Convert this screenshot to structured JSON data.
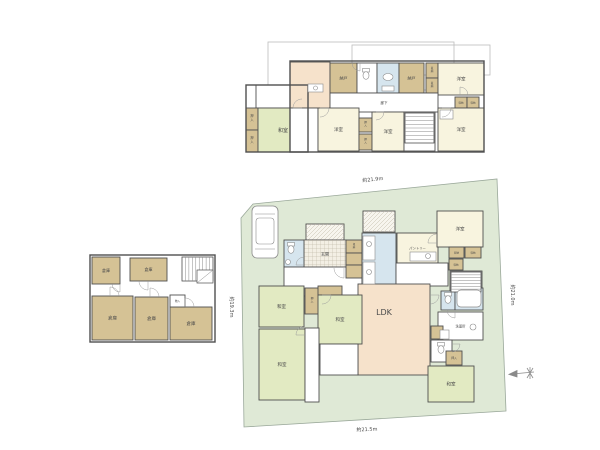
{
  "canvas": {
    "w": 600,
    "h": 450,
    "bg": "#ffffff"
  },
  "palette": {
    "g": "#e2eac2",
    "c": "#f8f4df",
    "t": "#d5c295",
    "b": "#d6e5ee",
    "p": "#f6e2cb",
    "w": "#ffffff",
    "hg": "#f3efe4",
    "hd": "#f7f5ee",
    "lot": "#dfe9d6",
    "lot_stroke": "#9aa89a",
    "wall": "#4f4f4f",
    "ref": "#bcbcbc",
    "fixture": "#8a8a8a",
    "text": "#4a4a4a",
    "dim_text": "#666666"
  },
  "lot": {
    "points": "241,218 253,204 497,179 506,411 244,427",
    "dims": [
      {
        "text": "約21.9m",
        "x": 373,
        "y": 181,
        "rot": -6
      },
      {
        "text": "約21.5m",
        "x": 367,
        "y": 431,
        "rot": -2
      },
      {
        "text": "約19.3m",
        "x": 230,
        "y": 307,
        "rot": 90
      },
      {
        "text": "約21.0m",
        "x": 511,
        "y": 295,
        "rot": 90
      }
    ]
  },
  "compass": {
    "x": 521,
    "y": 373
  },
  "floors": [
    {
      "id": "floor-plan-2f",
      "ref_outlines": [
        [
          268,
          42,
          186,
          48
        ],
        [
          352,
          45,
          138,
          30
        ]
      ],
      "wall_rects": [
        [
          246,
          85,
          62,
          67
        ],
        [
          290,
          61,
          194,
          91
        ]
      ],
      "rooms": [
        {
          "x": 256,
          "y": 85,
          "w": 34,
          "h": 23,
          "f": "w"
        },
        {
          "x": 246,
          "y": 108,
          "w": 12,
          "h": 22,
          "f": "t",
          "l": "押入",
          "v": 1,
          "fs": 3.2
        },
        {
          "x": 246,
          "y": 130,
          "w": 12,
          "h": 22,
          "f": "t",
          "l": "押入",
          "v": 1,
          "fs": 3.2
        },
        {
          "x": 258,
          "y": 108,
          "w": 50,
          "h": 44,
          "f": "g",
          "l": "和室",
          "fs": 5
        },
        {
          "x": 290,
          "y": 62,
          "w": 40,
          "h": 46,
          "f": "p"
        },
        {
          "x": 290,
          "y": 108,
          "w": 28,
          "h": 44,
          "f": "w"
        },
        {
          "x": 330,
          "y": 63,
          "w": 27,
          "h": 30,
          "f": "t",
          "l": "納戸",
          "fs": 4
        },
        {
          "x": 357,
          "y": 63,
          "w": 20,
          "h": 30,
          "f": "w"
        },
        {
          "x": 377,
          "y": 63,
          "w": 22,
          "h": 30,
          "f": "b"
        },
        {
          "x": 399,
          "y": 63,
          "w": 25,
          "h": 30,
          "f": "t",
          "l": "納戸",
          "fs": 4
        },
        {
          "x": 426,
          "y": 63,
          "w": 12,
          "h": 15,
          "f": "t",
          "l": "収納",
          "v": 1,
          "fs": 2.6
        },
        {
          "x": 426,
          "y": 78,
          "w": 12,
          "h": 15,
          "f": "t",
          "l": "収納",
          "v": 1,
          "fs": 2.6
        },
        {
          "x": 438,
          "y": 63,
          "w": 46,
          "h": 32,
          "f": "c",
          "l": "洋室",
          "fs": 4.5
        },
        {
          "x": 330,
          "y": 93,
          "w": 108,
          "h": 19,
          "f": "w",
          "l": "廊下",
          "fs": 3.5
        },
        {
          "x": 455,
          "y": 97,
          "w": 12,
          "h": 11,
          "f": "t",
          "l": "収納",
          "fs": 2.5
        },
        {
          "x": 467,
          "y": 97,
          "w": 12,
          "h": 11,
          "f": "t",
          "l": "収納",
          "fs": 2.5
        },
        {
          "x": 438,
          "y": 108,
          "w": 46,
          "h": 43,
          "f": "c",
          "l": "洋室",
          "fs": 4.5
        },
        {
          "x": 318,
          "y": 108,
          "w": 41,
          "h": 43,
          "f": "c",
          "l": "洋室",
          "fs": 4.5
        },
        {
          "x": 359,
          "y": 118,
          "w": 13,
          "h": 14,
          "f": "t",
          "l": "押入",
          "v": 1,
          "fs": 2.6
        },
        {
          "x": 359,
          "y": 134,
          "w": 13,
          "h": 16,
          "f": "t",
          "l": "押入",
          "v": 1,
          "fs": 2.6
        },
        {
          "x": 372,
          "y": 112,
          "w": 32,
          "h": 39,
          "f": "c",
          "l": "洋室",
          "fs": 4.5
        },
        {
          "x": 404,
          "y": 112,
          "w": 31,
          "h": 39,
          "f": "w"
        }
      ],
      "fixtures": [
        {
          "t": "box",
          "x": 308,
          "y": 84,
          "w": 15,
          "h": 8
        },
        {
          "t": "sink",
          "x": 315.5,
          "y": 88,
          "r": 2
        },
        {
          "t": "toilet",
          "x": 366,
          "y": 76
        },
        {
          "t": "oval",
          "x": 388,
          "y": 77,
          "rx": 5,
          "ry": 3.5
        },
        {
          "t": "box",
          "x": 382,
          "y": 86,
          "w": 12,
          "h": 5
        },
        {
          "t": "stairs",
          "x": 405,
          "y": 113,
          "w": 29,
          "h": 30,
          "n": 7,
          "o": "h"
        },
        {
          "t": "box",
          "x": 440,
          "y": 110,
          "w": 13,
          "h": 9
        }
      ],
      "doors": [
        {
          "x": 320,
          "y": 108,
          "r": 9,
          "a": 90
        },
        {
          "x": 376,
          "y": 112,
          "r": 8,
          "a": 90
        },
        {
          "x": 442,
          "y": 108,
          "r": 9,
          "a": 90
        },
        {
          "x": 360,
          "y": 63,
          "r": 8,
          "a": 180
        },
        {
          "x": 302,
          "y": 108,
          "r": 9,
          "a": -90
        },
        {
          "x": 460,
          "y": 95,
          "r": 8,
          "a": 0
        }
      ]
    },
    {
      "id": "floor-plan-b1",
      "ref_outlines": [],
      "wall_rects": [
        [
          90,
          255,
          125,
          87
        ]
      ],
      "rooms": [
        {
          "x": 92,
          "y": 257,
          "w": 28,
          "h": 27,
          "f": "t",
          "l": "倉庫",
          "fs": 4
        },
        {
          "x": 130,
          "y": 258,
          "w": 37,
          "h": 23,
          "f": "t",
          "l": "倉庫",
          "fs": 4
        },
        {
          "x": 92,
          "y": 296,
          "w": 41,
          "h": 44,
          "f": "t",
          "l": "倉庫",
          "fs": 4.5
        },
        {
          "x": 135,
          "y": 297,
          "w": 33,
          "h": 43,
          "f": "t",
          "l": "倉庫",
          "fs": 4.5
        },
        {
          "x": 170,
          "y": 307,
          "w": 42,
          "h": 33,
          "f": "t",
          "l": "倉庫",
          "fs": 4.5
        },
        {
          "x": 170,
          "y": 295,
          "w": 15,
          "h": 12,
          "f": "w",
          "l": "物入",
          "fs": 2.6
        }
      ],
      "fixtures": [
        {
          "t": "stairs",
          "x": 182,
          "y": 257,
          "w": 31,
          "h": 24,
          "n": 8,
          "o": "v"
        },
        {
          "t": "landing",
          "x": 197,
          "y": 270,
          "w": 16,
          "h": 13
        }
      ],
      "doors": [
        {
          "x": 148,
          "y": 281,
          "r": 9,
          "a": 180
        },
        {
          "x": 110,
          "y": 296,
          "r": 9,
          "a": 0
        },
        {
          "x": 150,
          "y": 297,
          "r": 9,
          "a": 0
        },
        {
          "x": 185,
          "y": 307,
          "r": 9,
          "a": 0
        },
        {
          "x": 120,
          "y": 284,
          "r": 8,
          "a": 180
        }
      ]
    },
    {
      "id": "floor-plan-1f",
      "ref_outlines": [],
      "wall_rects": [],
      "rooms": [
        {
          "x": 363,
          "y": 211,
          "w": 32,
          "h": 21,
          "f": "hd"
        },
        {
          "x": 306,
          "y": 224,
          "w": 38,
          "h": 16,
          "f": "hd"
        },
        {
          "x": 304,
          "y": 240,
          "w": 42,
          "h": 28,
          "f": "hg",
          "l": "玄関",
          "fs": 4
        },
        {
          "x": 284,
          "y": 240,
          "w": 20,
          "h": 27,
          "f": "b"
        },
        {
          "x": 284,
          "y": 267,
          "w": 78,
          "h": 29,
          "f": "w"
        },
        {
          "x": 346,
          "y": 240,
          "w": 16,
          "h": 13,
          "f": "t",
          "l": "収納",
          "v": 1,
          "fs": 2.5
        },
        {
          "x": 346,
          "y": 253,
          "w": 16,
          "h": 12,
          "f": "t"
        },
        {
          "x": 346,
          "y": 265,
          "w": 16,
          "h": 13,
          "f": "t"
        },
        {
          "x": 362,
          "y": 233,
          "w": 34,
          "h": 55,
          "f": "b"
        },
        {
          "x": 397,
          "y": 233,
          "w": 41,
          "h": 30,
          "f": "c",
          "l": "パントリー",
          "fs": 3.3
        },
        {
          "x": 396,
          "y": 263,
          "w": 52,
          "h": 23,
          "f": "w"
        },
        {
          "x": 437,
          "y": 211,
          "w": 46,
          "h": 36,
          "f": "c",
          "l": "洋室",
          "fs": 4.5
        },
        {
          "x": 449,
          "y": 247,
          "w": 15,
          "h": 11,
          "f": "t",
          "l": "収納",
          "fs": 2.5
        },
        {
          "x": 465,
          "y": 247,
          "w": 16,
          "h": 11,
          "f": "t",
          "l": "収納",
          "fs": 2.5
        },
        {
          "x": 449,
          "y": 259,
          "w": 14,
          "h": 11,
          "f": "t",
          "l": "収納",
          "fs": 2.5
        },
        {
          "x": 450,
          "y": 271,
          "w": 32,
          "h": 22,
          "f": "w"
        },
        {
          "x": 358,
          "y": 284,
          "w": 72,
          "h": 91,
          "f": "p",
          "l": "LDK",
          "fs": 8,
          "lx": 384,
          "ly": 315
        },
        {
          "x": 441,
          "y": 291,
          "w": 14,
          "h": 19,
          "f": "b"
        },
        {
          "x": 455,
          "y": 288,
          "w": 28,
          "h": 22,
          "f": "b"
        },
        {
          "x": 438,
          "y": 312,
          "w": 45,
          "h": 28,
          "f": "w",
          "l": "洗面所",
          "fs": 3.3
        },
        {
          "x": 431,
          "y": 326,
          "w": 12,
          "h": 13,
          "f": "t"
        },
        {
          "x": 431,
          "y": 340,
          "w": 21,
          "h": 22,
          "f": "w"
        },
        {
          "x": 259,
          "y": 286,
          "w": 45,
          "h": 41,
          "f": "g",
          "l": "和室",
          "fs": 4.5
        },
        {
          "x": 259,
          "y": 329,
          "w": 46,
          "h": 71,
          "f": "g",
          "l": "和室",
          "fs": 4.5
        },
        {
          "x": 305,
          "y": 288,
          "w": 14,
          "h": 26,
          "f": "t",
          "l": "押入",
          "v": 1,
          "fs": 2.8
        },
        {
          "x": 318,
          "y": 286,
          "w": 24,
          "h": 9,
          "f": "t"
        },
        {
          "x": 318,
          "y": 295,
          "w": 44,
          "h": 49,
          "f": "g",
          "l": "和室",
          "fs": 4.5
        },
        {
          "x": 305,
          "y": 328,
          "w": 14,
          "h": 74,
          "f": "w"
        },
        {
          "x": 320,
          "y": 344,
          "w": 38,
          "h": 31,
          "f": "w"
        },
        {
          "x": 428,
          "y": 366,
          "w": 46,
          "h": 36,
          "f": "g",
          "l": "和室",
          "fs": 4.5
        },
        {
          "x": 446,
          "y": 351,
          "w": 16,
          "h": 14,
          "f": "t",
          "l": "押入",
          "fs": 2.8
        }
      ],
      "fixtures": [
        {
          "t": "car",
          "x": 252,
          "y": 206,
          "w": 26,
          "h": 52
        },
        {
          "t": "toilet",
          "x": 291,
          "y": 250
        },
        {
          "t": "sink",
          "x": 288,
          "y": 262,
          "r": 2.5
        },
        {
          "t": "box",
          "x": 363,
          "y": 236,
          "w": 12,
          "h": 24
        },
        {
          "t": "sink",
          "x": 369,
          "y": 244,
          "r": 2.5
        },
        {
          "t": "box",
          "x": 363,
          "y": 262,
          "w": 12,
          "h": 22
        },
        {
          "t": "sink",
          "x": 369,
          "y": 272,
          "r": 2.5
        },
        {
          "t": "box",
          "x": 410,
          "y": 252,
          "w": 26,
          "h": 9
        },
        {
          "t": "sink",
          "x": 428,
          "y": 256,
          "r": 2.5
        },
        {
          "t": "stairs",
          "x": 451,
          "y": 272,
          "w": 30,
          "h": 20,
          "n": 6,
          "o": "h"
        },
        {
          "t": "tub",
          "x": 457,
          "y": 290,
          "w": 24,
          "h": 17
        },
        {
          "t": "toilet",
          "x": 448,
          "y": 300
        },
        {
          "t": "sink",
          "x": 473,
          "y": 327,
          "r": 3
        },
        {
          "t": "box",
          "x": 440,
          "y": 330,
          "w": 9,
          "h": 9
        },
        {
          "t": "toilet",
          "x": 441,
          "y": 350
        }
      ],
      "doors": [
        {
          "x": 344,
          "y": 268,
          "r": 10,
          "a": 180
        },
        {
          "x": 304,
          "y": 265,
          "r": 8,
          "a": -90
        },
        {
          "x": 322,
          "y": 295,
          "r": 9,
          "a": 90
        },
        {
          "x": 305,
          "y": 335,
          "r": 9,
          "a": -90
        },
        {
          "x": 437,
          "y": 243,
          "r": 9,
          "a": -90
        },
        {
          "x": 455,
          "y": 310,
          "r": 8,
          "a": 180
        },
        {
          "x": 452,
          "y": 344,
          "r": 8,
          "a": 90
        },
        {
          "x": 430,
          "y": 295,
          "r": 9,
          "a": 90
        }
      ]
    }
  ]
}
